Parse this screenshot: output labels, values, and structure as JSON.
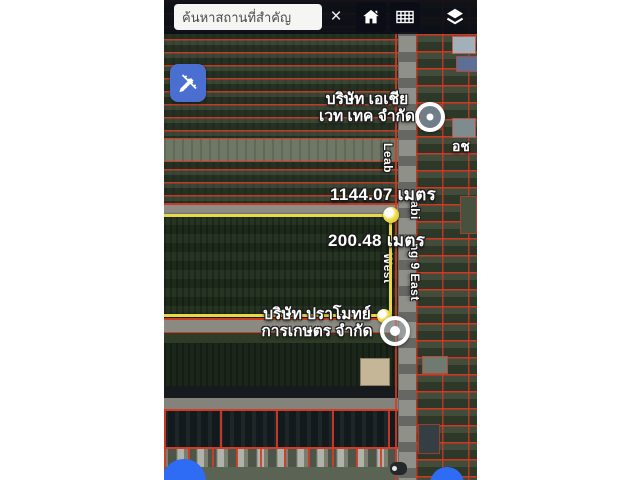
{
  "topbar": {
    "search_placeholder": "ค้นหาสถานที่สำคัญ",
    "clear_label": "×"
  },
  "map": {
    "labels": {
      "company1": {
        "line1": "บริษัท เอเชีย",
        "line2": "เวท เทค จำกัด"
      },
      "company2": {
        "line1": "บริษัท ปราโมทย์",
        "line2": "การเกษตร จำกัด"
      },
      "measure_top": "1144.07 เมตร",
      "measure_right": "200.48 เมตร",
      "partial": "อช"
    },
    "road": {
      "left_fragment1": "Leab",
      "left_fragment2": "West",
      "right_fragment1": "abi",
      "right_fragment2": "ng 9 East"
    },
    "colors": {
      "measure_line": "#e8d94a",
      "parcel_line": "#d23b26",
      "edit_button_blue": "#4a6fd0",
      "fab_blue": "#2e6cf5"
    }
  }
}
